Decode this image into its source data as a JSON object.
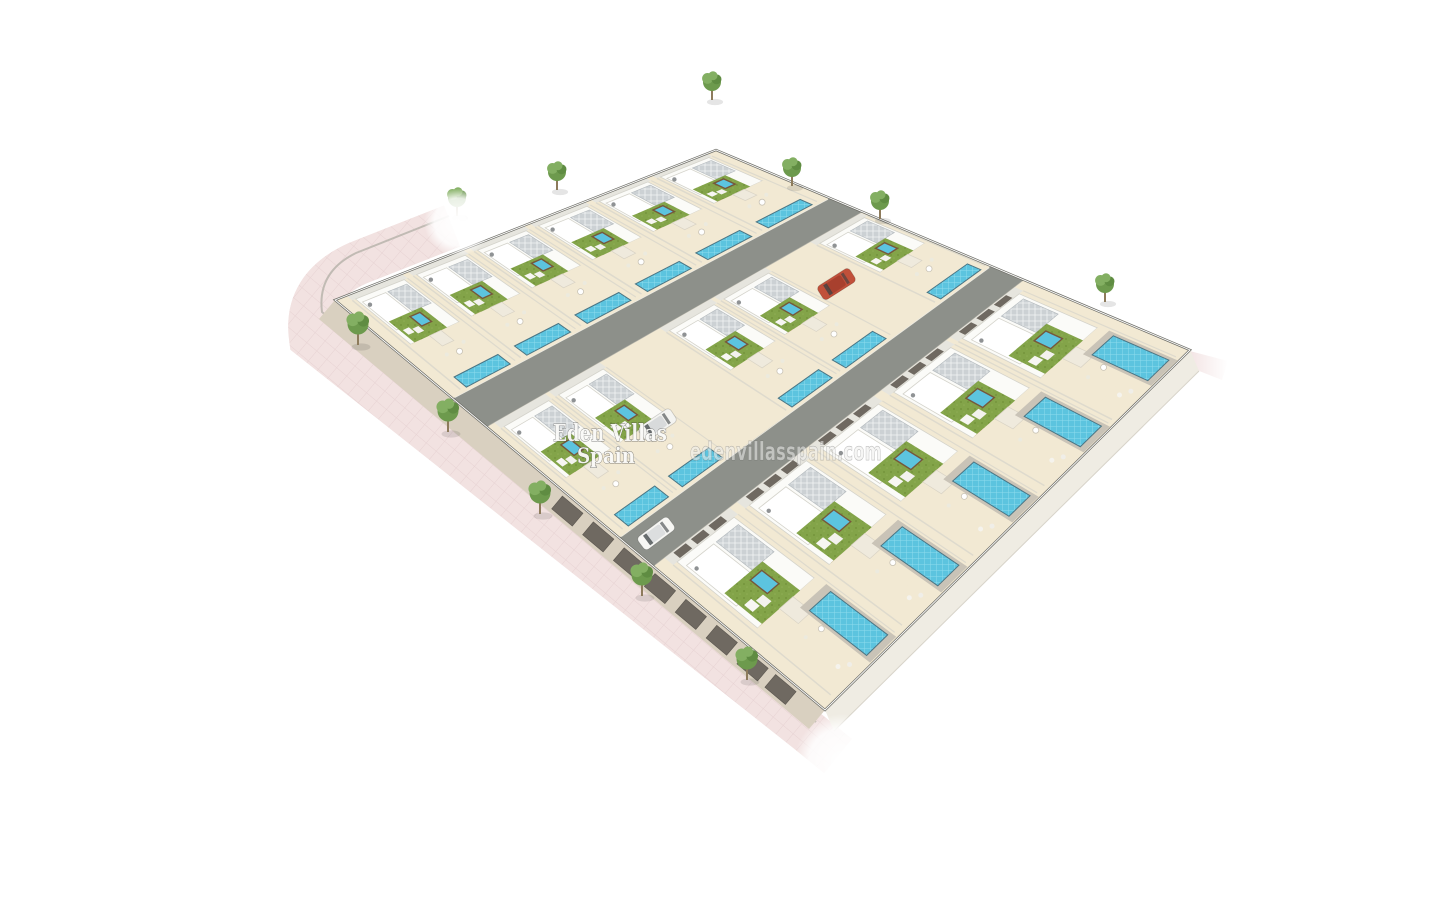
{
  "watermarks": {
    "title_line1": "Eden Villas",
    "title_line2": "Spain",
    "website": "edenvillasspain.com"
  },
  "colors": {
    "background": "#ffffff",
    "ground": "#f1ebdc",
    "terrace": "#f2e9d3",
    "road": "#8d908a",
    "roadDark": "#75786f",
    "sidewalkPink": "#f2e2e1",
    "sidewalkLine": "#ddc6c7",
    "pool": "#5cc4df",
    "poolTile": "#8edcee",
    "poolEdge": "#4b7584",
    "turf": "#83a449",
    "turfDark": "#74953c",
    "solar": "#ccd1d4",
    "stone": "#d3c093",
    "wallWhite": "#fbfbf8",
    "wallShade": "#e6e5de",
    "wallEdge": "#d4d3cb",
    "wallFaceLB": "#d9d0c0",
    "wallFaceBR": "#efece3",
    "garageDoor": "#6f6961",
    "treeFoliage": "#6d9a4d",
    "treeFoliageLight": "#83af62",
    "treeFoliageDark": "#5f8c42",
    "treeTrunk": "#8d7b5c",
    "carRed": "#c1503a",
    "carWhite": "#f4f4f1",
    "perimeter": "#6f6f68"
  },
  "scene": {
    "canvas": [
      1440,
      900
    ],
    "quad": {
      "L": [
        335,
        300
      ],
      "T": [
        716,
        150
      ],
      "R": [
        1190,
        350
      ],
      "B": [
        825,
        710
      ]
    },
    "strips": [
      {
        "b0": 0.0,
        "db": 0.24,
        "front": false,
        "villas": [
          {
            "a": 0.03,
            "w": 0.145
          },
          {
            "a": 0.19,
            "w": 0.145
          },
          {
            "a": 0.35,
            "w": 0.145
          },
          {
            "a": 0.51,
            "w": 0.145
          },
          {
            "a": 0.67,
            "w": 0.145
          },
          {
            "a": 0.83,
            "w": 0.145
          }
        ]
      },
      {
        "b0": 0.31,
        "db": 0.27,
        "front": false,
        "villas": [
          {
            "a": 0.02,
            "w": 0.135
          },
          {
            "a": 0.165,
            "w": 0.135
          },
          {
            "a": 0.46,
            "w": 0.135
          },
          {
            "a": 0.605,
            "w": 0.135
          },
          {
            "a": 0.86,
            "w": 0.135
          }
        ]
      },
      {
        "b0": 0.65,
        "db": 0.35,
        "front": true,
        "villas": [
          {
            "a": 0.03,
            "w": 0.175
          },
          {
            "a": 0.225,
            "w": 0.175
          },
          {
            "a": 0.42,
            "w": 0.175
          },
          {
            "a": 0.615,
            "w": 0.175
          },
          {
            "a": 0.8,
            "w": 0.175
          }
        ]
      }
    ],
    "roads": [
      {
        "b0": 0.24,
        "b1": 0.31
      },
      {
        "b0": 0.58,
        "b1": 0.65
      }
    ],
    "connector": {
      "a0": 0.31,
      "a1": 0.43,
      "b0": 0.31,
      "b1": 0.58
    },
    "driveway": {
      "a0": 0.73,
      "a1": 0.85,
      "b0": 0.31,
      "b1": 0.52
    },
    "sidewalk": {
      "path": "M452,226 L358,263 Q304,287 311,338 L806,730 L838,756",
      "width": 44
    },
    "curb": {
      "path": "M449,216 L356,253 Q317,272 322,312 L816,722"
    },
    "fadeSpots": [
      {
        "c": [
          458,
          222
        ],
        "r": 34
      },
      {
        "c": [
          842,
          762
        ],
        "r": 48
      }
    ],
    "stub": [
      [
        1186,
        350
      ],
      [
        1228,
        361
      ],
      [
        1222,
        380
      ],
      [
        1184,
        365
      ]
    ],
    "lbWall": {
      "offset": [
        -16,
        19
      ],
      "garageDoors": [
        0.47,
        0.533,
        0.596,
        0.659,
        0.722,
        0.785,
        0.848,
        0.905
      ]
    },
    "brWall": {
      "offset": [
        9,
        21
      ]
    },
    "trees": {
      "street": [
        [
          457,
          216
        ],
        [
          557,
          190
        ],
        [
          712,
          100
        ],
        [
          792,
          186
        ],
        [
          880,
          219
        ],
        [
          1105,
          302
        ]
      ],
      "sidewalk": [
        [
          358,
          345
        ],
        [
          448,
          432
        ],
        [
          540,
          514
        ],
        [
          642,
          596
        ],
        [
          747,
          680
        ]
      ]
    },
    "cars": [
      {
        "a": 0.79,
        "b": 0.42,
        "color": "#c1503a",
        "cabin": "#a8402e"
      },
      {
        "a": 0.26,
        "b": 0.46,
        "color": "#f4f4f1",
        "cabin": "#d8dadb"
      },
      {
        "a": 0.06,
        "b": 0.61,
        "color": "#f7f7f4",
        "cabin": "#dcdedf"
      }
    ],
    "watermark_pos": {
      "line1": {
        "x": 610,
        "y": 441,
        "size": 23,
        "len": 114
      },
      "line2": {
        "x": 606,
        "y": 463,
        "size": 21,
        "len": 58
      },
      "website": {
        "x": 786,
        "y": 460,
        "size": 25,
        "len": 192
      }
    }
  }
}
